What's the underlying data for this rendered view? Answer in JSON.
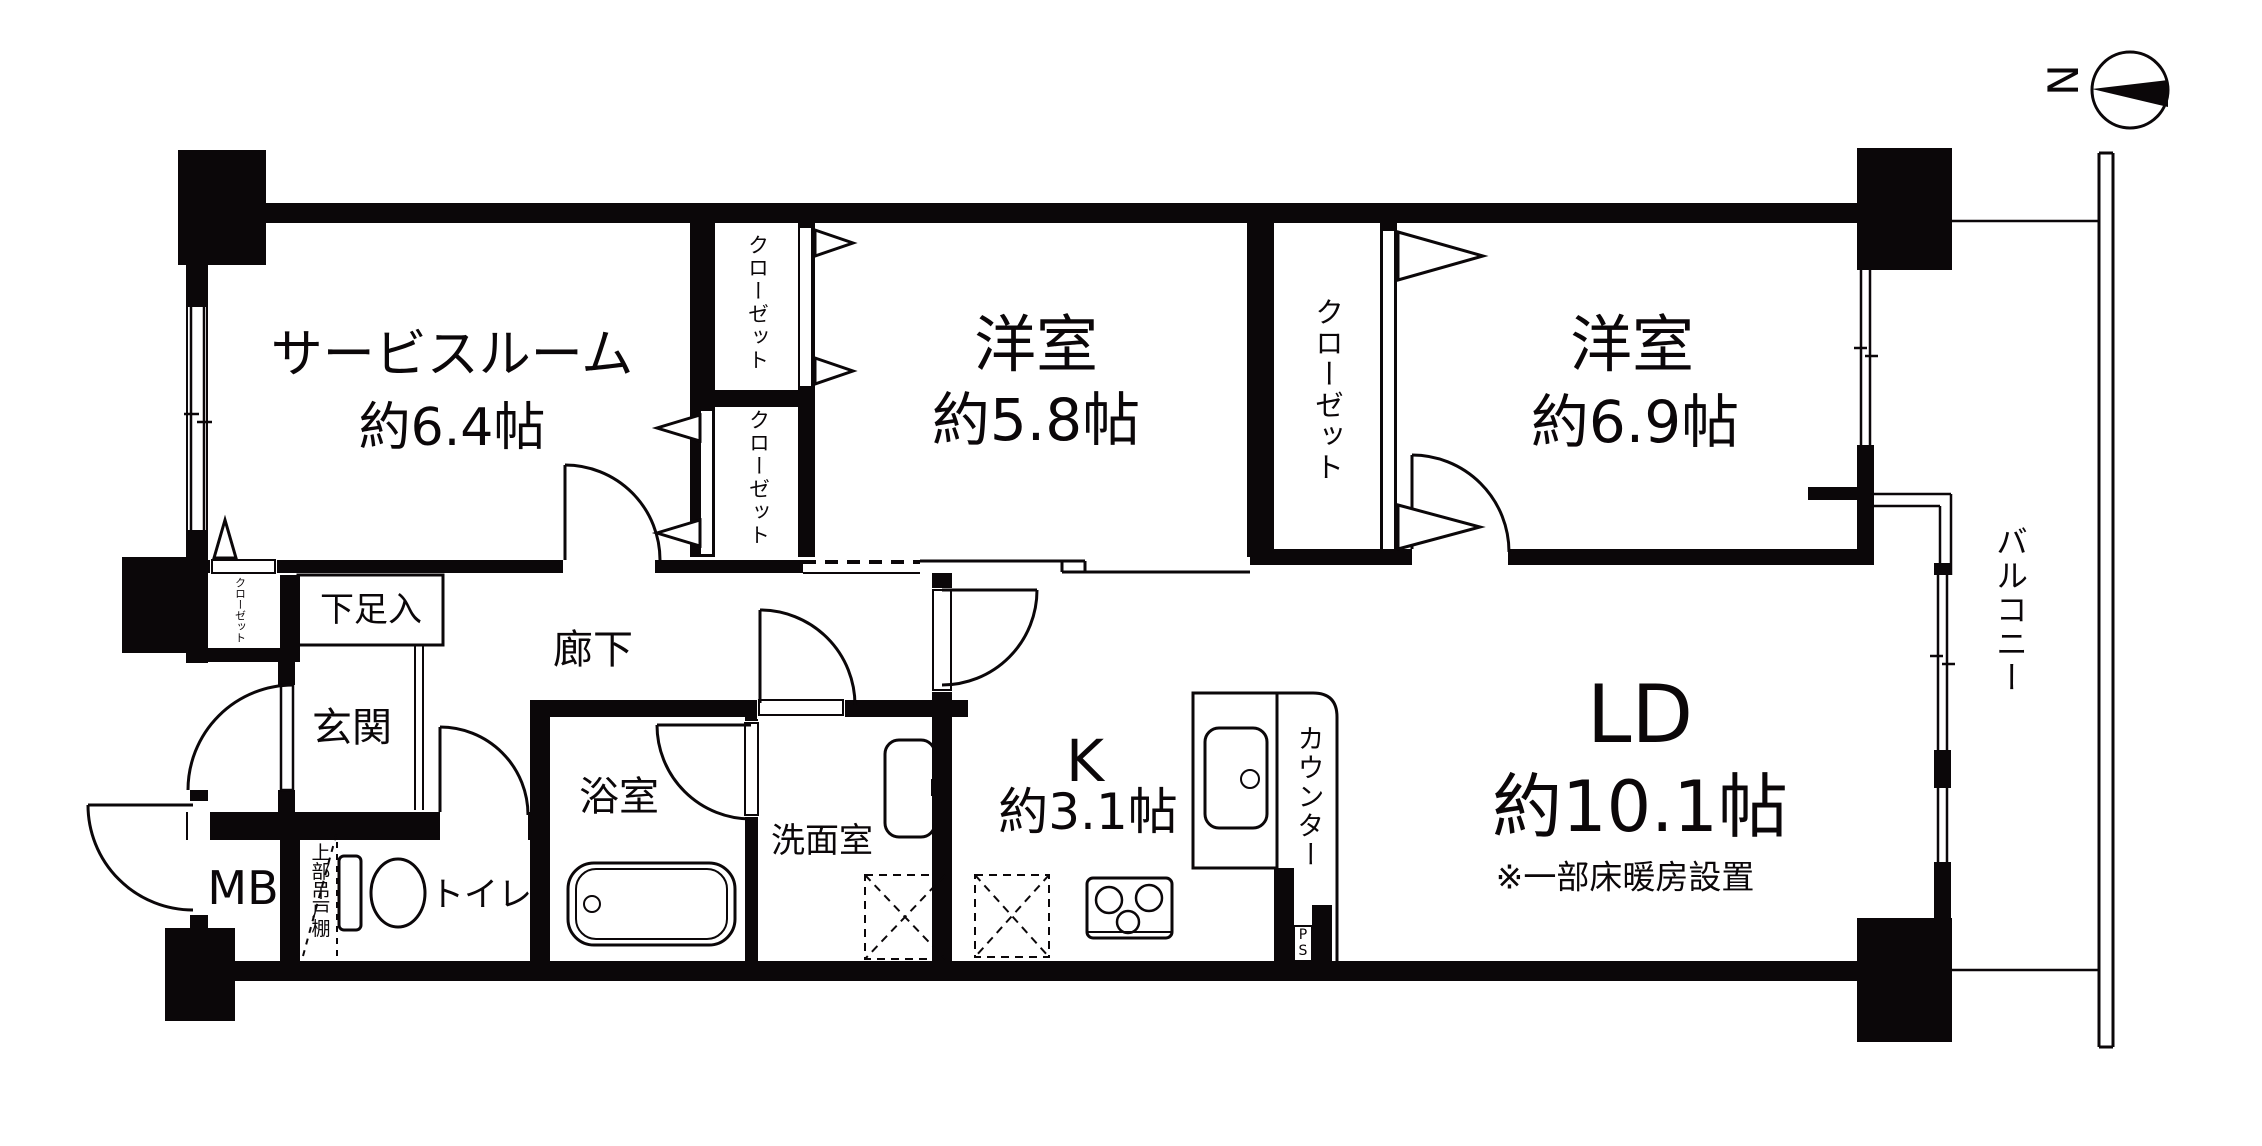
{
  "colors": {
    "ink": "#0b0709",
    "paper": "#ffffff"
  },
  "compass": {
    "north": "N"
  },
  "labels": {
    "service_room_name": "サービスルーム",
    "service_room_size": "約6.4帖",
    "bedroom1_name": "洋室",
    "bedroom1_size": "約5.8帖",
    "bedroom2_name": "洋室",
    "bedroom2_size": "約6.9帖",
    "ld_name": "LD",
    "ld_size": "約10.1帖",
    "ld_note": "※一部床暖房設置",
    "kitchen_name": "K",
    "kitchen_size": "約3.1帖",
    "hallway": "廊下",
    "entrance": "玄関",
    "shoe_cabinet": "下足入",
    "bathroom": "浴室",
    "washroom": "洗面室",
    "toilet": "トイレ",
    "meter_box": "MB",
    "pipe_space": "PS",
    "counter": "カウンター",
    "balcony": "バルコニー",
    "upper_cabinet": "上部吊戸棚",
    "closet_a_top": "クローゼット",
    "closet_a_bottom": "クローゼット",
    "closet_b": "クローゼット",
    "closet_entry": "クローゼット"
  }
}
